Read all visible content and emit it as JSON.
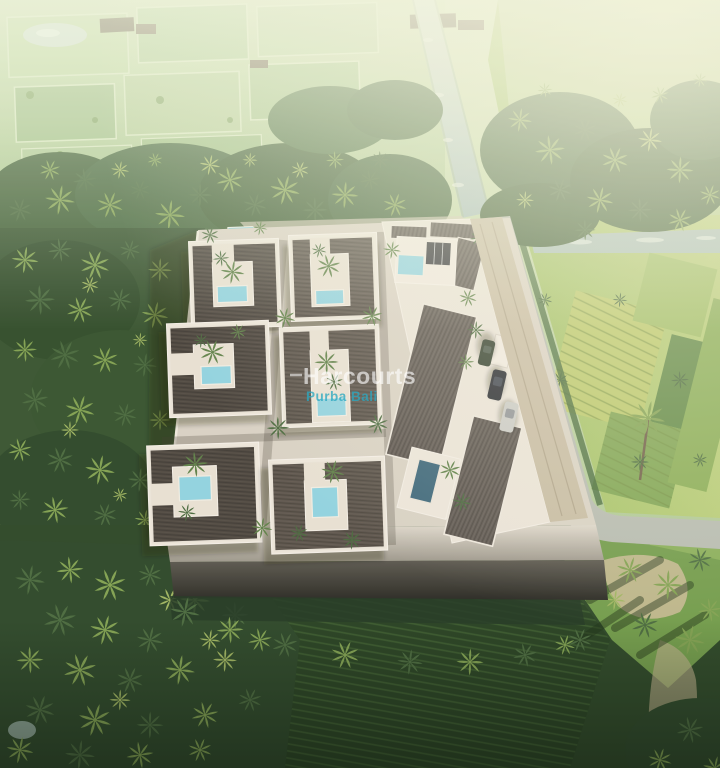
{
  "meta": {
    "description": "Aerial 3D architectural render of a walled tropical villa development surrounded by palm groves and rice fields",
    "kind": "real-estate-aerial-render"
  },
  "watermark": {
    "brand": "Harcourts",
    "office": "Purba Bali",
    "brand_color": "rgba(255,255,255,0.62)",
    "office_color": "rgba(44,168,192,0.78)"
  },
  "scene": {
    "courtyard_villas": 6,
    "pool_color": "#8fd2e0",
    "pool_dark_color": "#3a6579",
    "roof_color": "#575048",
    "wall_color": "#ece6db",
    "platform_color": "#d8d1c4",
    "canal_color": "#b9cdc7",
    "road_color": "#b5bab0",
    "driveway_color": "#c6bba2",
    "field_bright_color": "#a4c364",
    "field_hazy_color": "#c2d6a8",
    "forest_color": "#3c5c33",
    "lawn_color": "#6f9a48",
    "cars": [
      "#23272e",
      "#c9cac6",
      "#2f3d2c"
    ]
  }
}
